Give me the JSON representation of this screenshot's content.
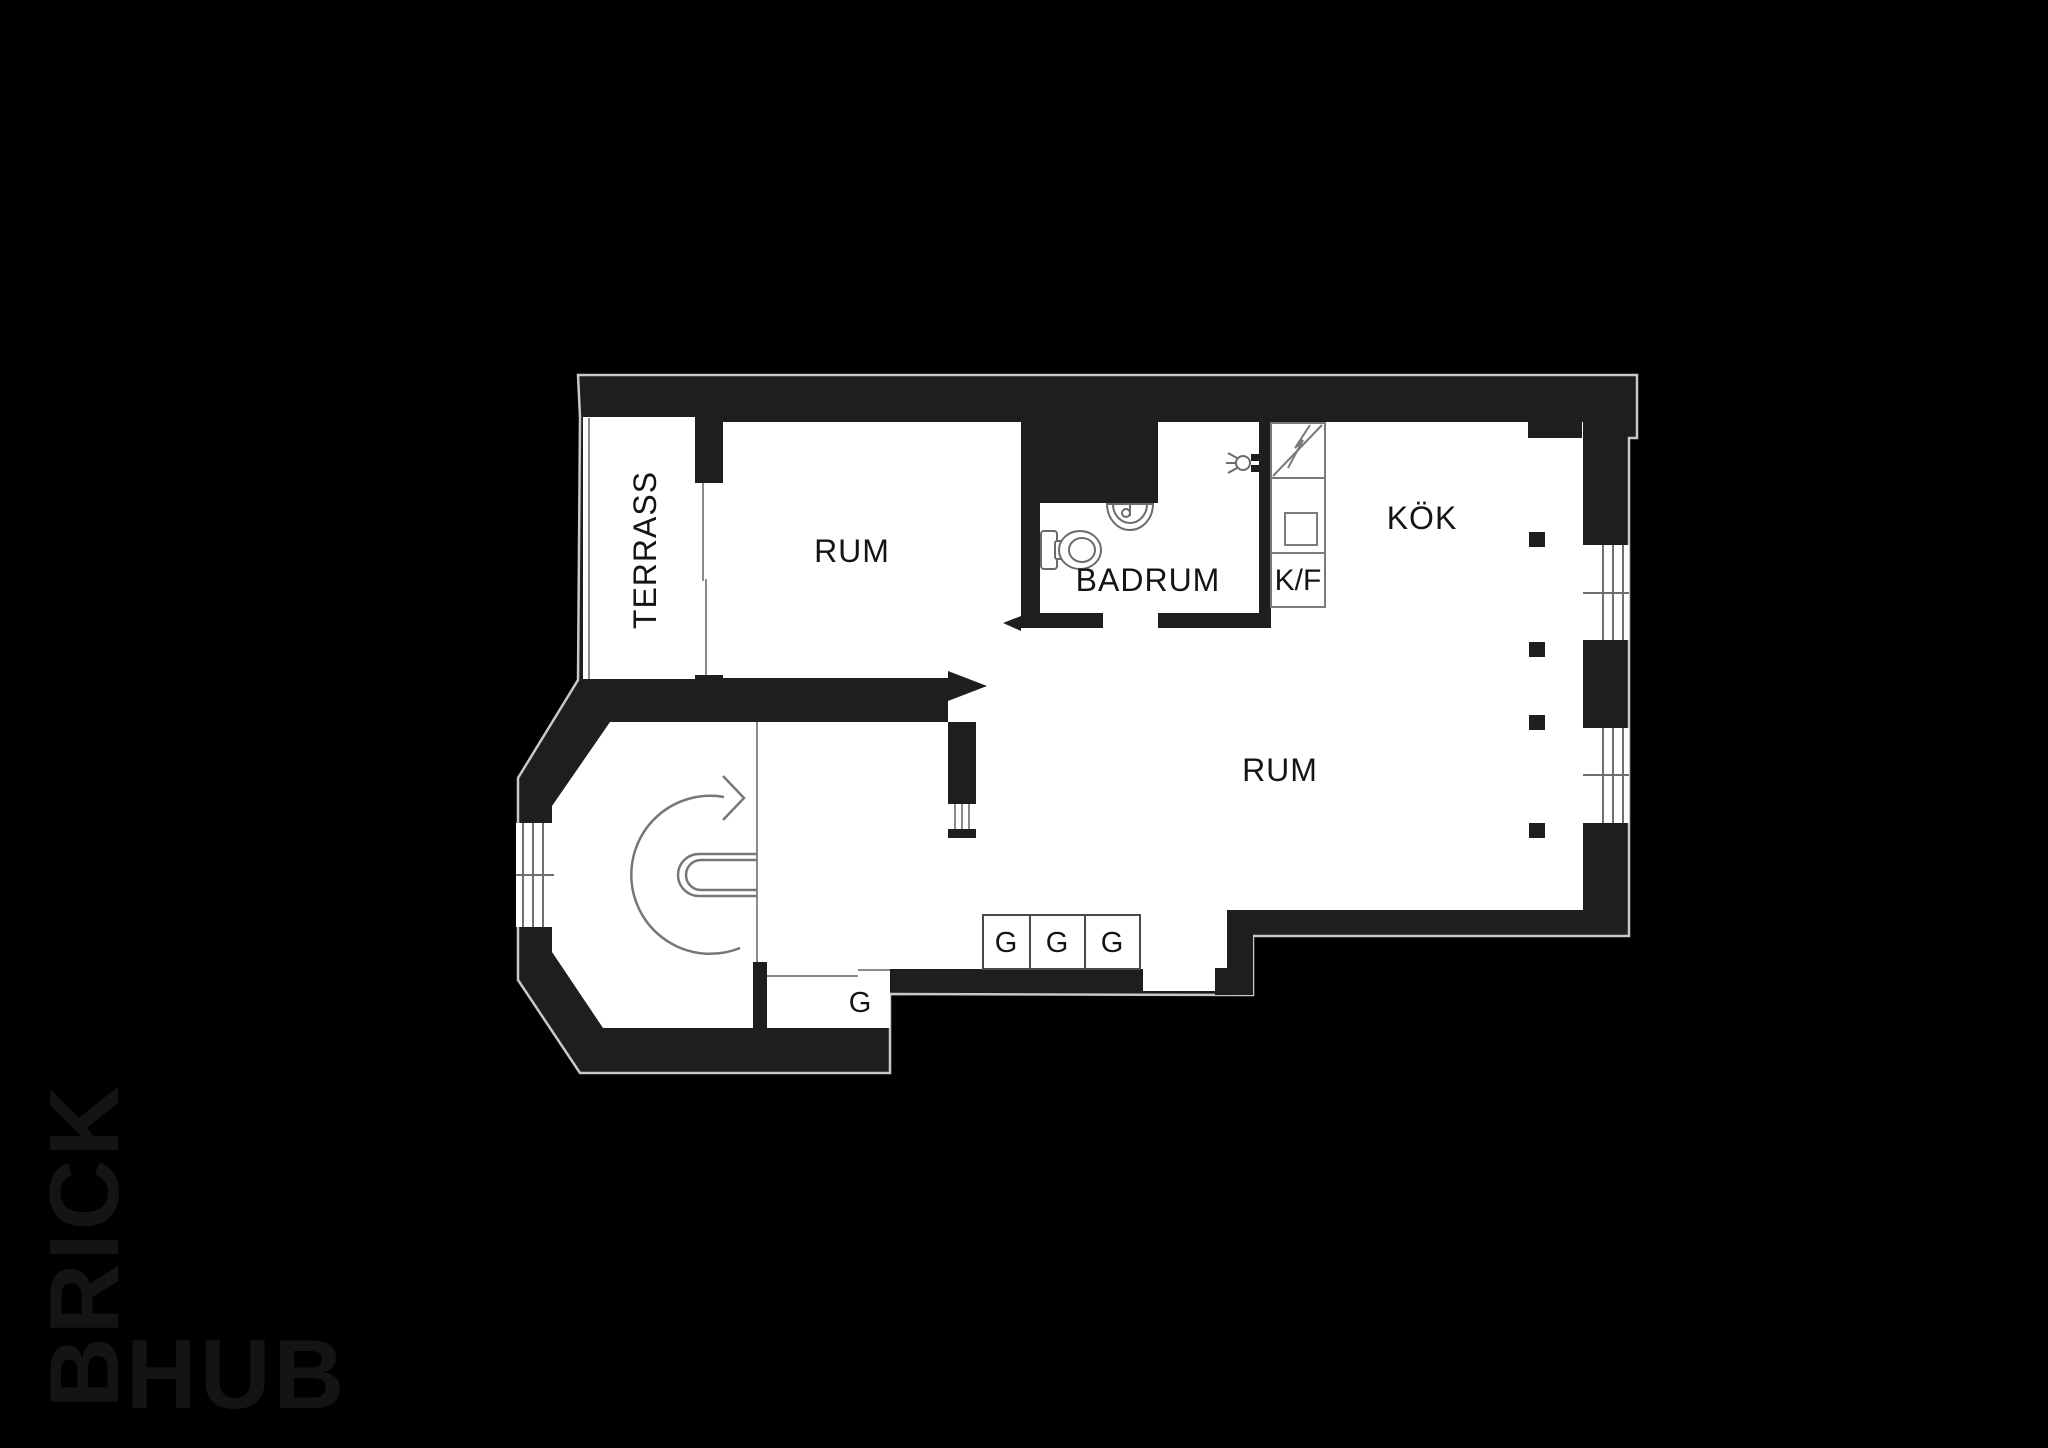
{
  "labels": {
    "terrass": "TERRASS",
    "room_top": "RUM",
    "bathroom": "BADRUM",
    "fridge_freezer": "K/F",
    "kitchen": "KÖK",
    "room_main": "RUM",
    "closet_bottom": "G",
    "closet_1": "G",
    "closet_2": "G",
    "closet_3": "G"
  },
  "logo": {
    "brick": "BRICK",
    "hub": "HUB"
  },
  "icons": {
    "toilet": "toilet-icon",
    "sink": "sink-icon",
    "shower": "shower-icon",
    "stove": "stove-lightning-icon",
    "appliance_square": "appliance-square-icon",
    "stair_direction": "stair-direction-arrow-icon",
    "door_arrow_right": "door-arrow-right-icon",
    "door_arrow_left": "door-arrow-left-icon",
    "windows": "window-icon",
    "radiators": "radiator-icon"
  },
  "colors": {
    "background": "#000000",
    "wall": "#1f1e1c",
    "floor": "#ffffff",
    "outline": "#c8c8c8",
    "furniture_line": "#6f6f6f",
    "glass_line": "#9a9a9a",
    "label": "#141414",
    "logo": "#2b2a29"
  }
}
